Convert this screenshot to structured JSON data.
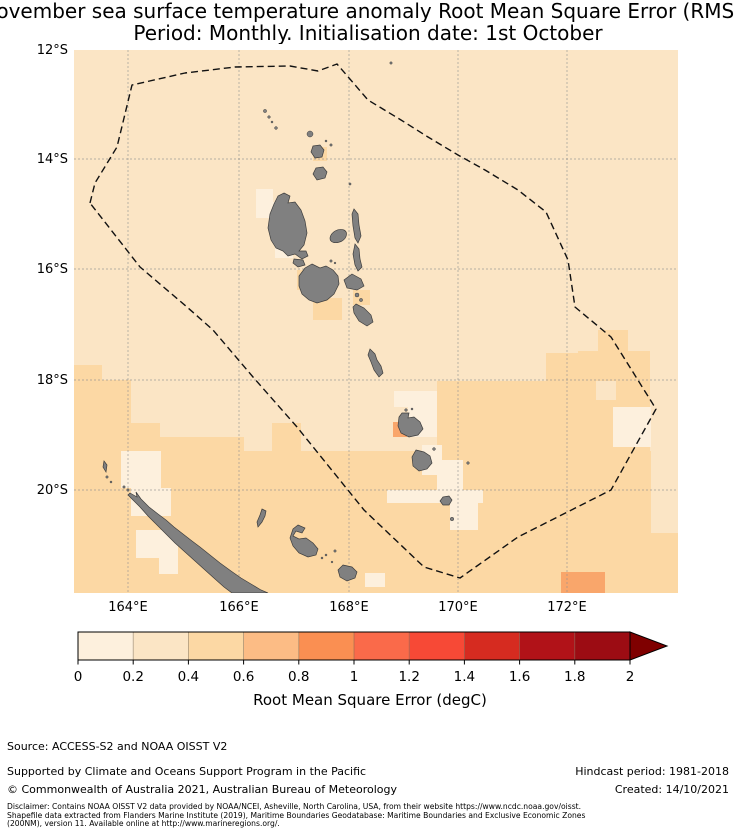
{
  "title": {
    "line1": "November sea surface temperature anomaly Root Mean Square Error (RMSE)",
    "line2": "Period: Monthly. Initialisation date: 1st October"
  },
  "axes": {
    "lat_ticks": [
      "12°S",
      "14°S",
      "16°S",
      "18°S",
      "20°S"
    ],
    "lon_ticks": [
      "164°E",
      "166°E",
      "168°E",
      "170°E",
      "172°E"
    ]
  },
  "map": {
    "region": "Vanuatu EEZ and surrounding southwest Pacific (New Caledonia at lower left)",
    "lon_range": [
      "163°E",
      "174°E"
    ],
    "lat_range": [
      "12°S",
      "22°S"
    ],
    "background_color": "#fbe5c5",
    "land_color": "#808080",
    "eez_boundary_style": "black dashed"
  },
  "colorbar": {
    "label": "Root Mean Square Error (degC)",
    "ticks": [
      "0",
      "0.2",
      "0.4",
      "0.6",
      "0.8",
      "1",
      "1.2",
      "1.4",
      "1.6",
      "1.8",
      "2"
    ],
    "colors": [
      "#fdf0dd",
      "#fbe5c5",
      "#fcd8a4",
      "#fcbc85",
      "#fa8f52",
      "#fa6a4a",
      "#f74936",
      "#d62b20",
      "#b11218",
      "#9c0c13"
    ],
    "arrow_color": "#7f0000"
  },
  "footer": {
    "source": "Source: ACCESS-S2 and NOAA OISST V2",
    "supported": "Supported by Climate and Oceans Support Program in the Pacific",
    "copyright": "© Commonwealth of Australia 2021, Australian Bureau of Meteorology",
    "hindcast": "Hindcast period: 1981-2018",
    "created": "Created: 14/10/2021",
    "disclaimer_lines": [
      "Disclaimer: Contains NOAA OISST V2 data provided by NOAA/NCEI, Asheville, North Carolina, USA, from their website https://www.ncdc.noaa.gov/oisst.",
      "Shapefile data extracted from Flanders Marine Institute (2019), Maritime Boundaries Geodatabase: Maritime Boundaries and Exclusive Economic Zones",
      "(200NM), version 11. Available online at http://www.marineregions.org/."
    ]
  },
  "chart_data": {
    "type": "heatmap",
    "title": "November sea surface temperature anomaly Root Mean Square Error (RMSE)",
    "subtitle": "Period: Monthly. Initialisation date: 1st October",
    "colorbar_label": "Root Mean Square Error (degC)",
    "colorbar_ticks": [
      0,
      0.2,
      0.4,
      0.6,
      0.8,
      1,
      1.2,
      1.4,
      1.6,
      1.8,
      2
    ],
    "colorbar_extends_above_max": true,
    "x_ticks": [
      "164°E",
      "166°E",
      "168°E",
      "170°E",
      "172°E"
    ],
    "y_ticks": [
      "12°S",
      "14°S",
      "16°S",
      "18°S",
      "20°S"
    ],
    "grid": true,
    "value_bins_degC": [
      [
        0,
        0.2
      ],
      [
        0.2,
        0.4
      ],
      [
        0.4,
        0.6
      ],
      [
        0.6,
        0.8
      ],
      [
        0.8,
        1.0
      ],
      [
        1.0,
        1.2
      ],
      [
        1.2,
        1.4
      ],
      [
        1.4,
        1.6
      ],
      [
        1.6,
        1.8
      ],
      [
        1.8,
        2.0
      ]
    ],
    "value_summary": "RMSE is mostly 0.2-0.4 degC north of ~18°S inside the dashed Vanuatu EEZ; 0.4-0.6 degC across the southern third (around and south of New Caledonia and southern Vanuatu); patches of 0-0.2 degC hug Espiritu Santo, Efate, Erromango/Tanna and the reefs northwest of New Caledonia; isolated 0.6-0.8 degC cells occur just west of Efate (~168.2°E, 17.7°S) and near 171.9°E, 21.6°S."
  }
}
